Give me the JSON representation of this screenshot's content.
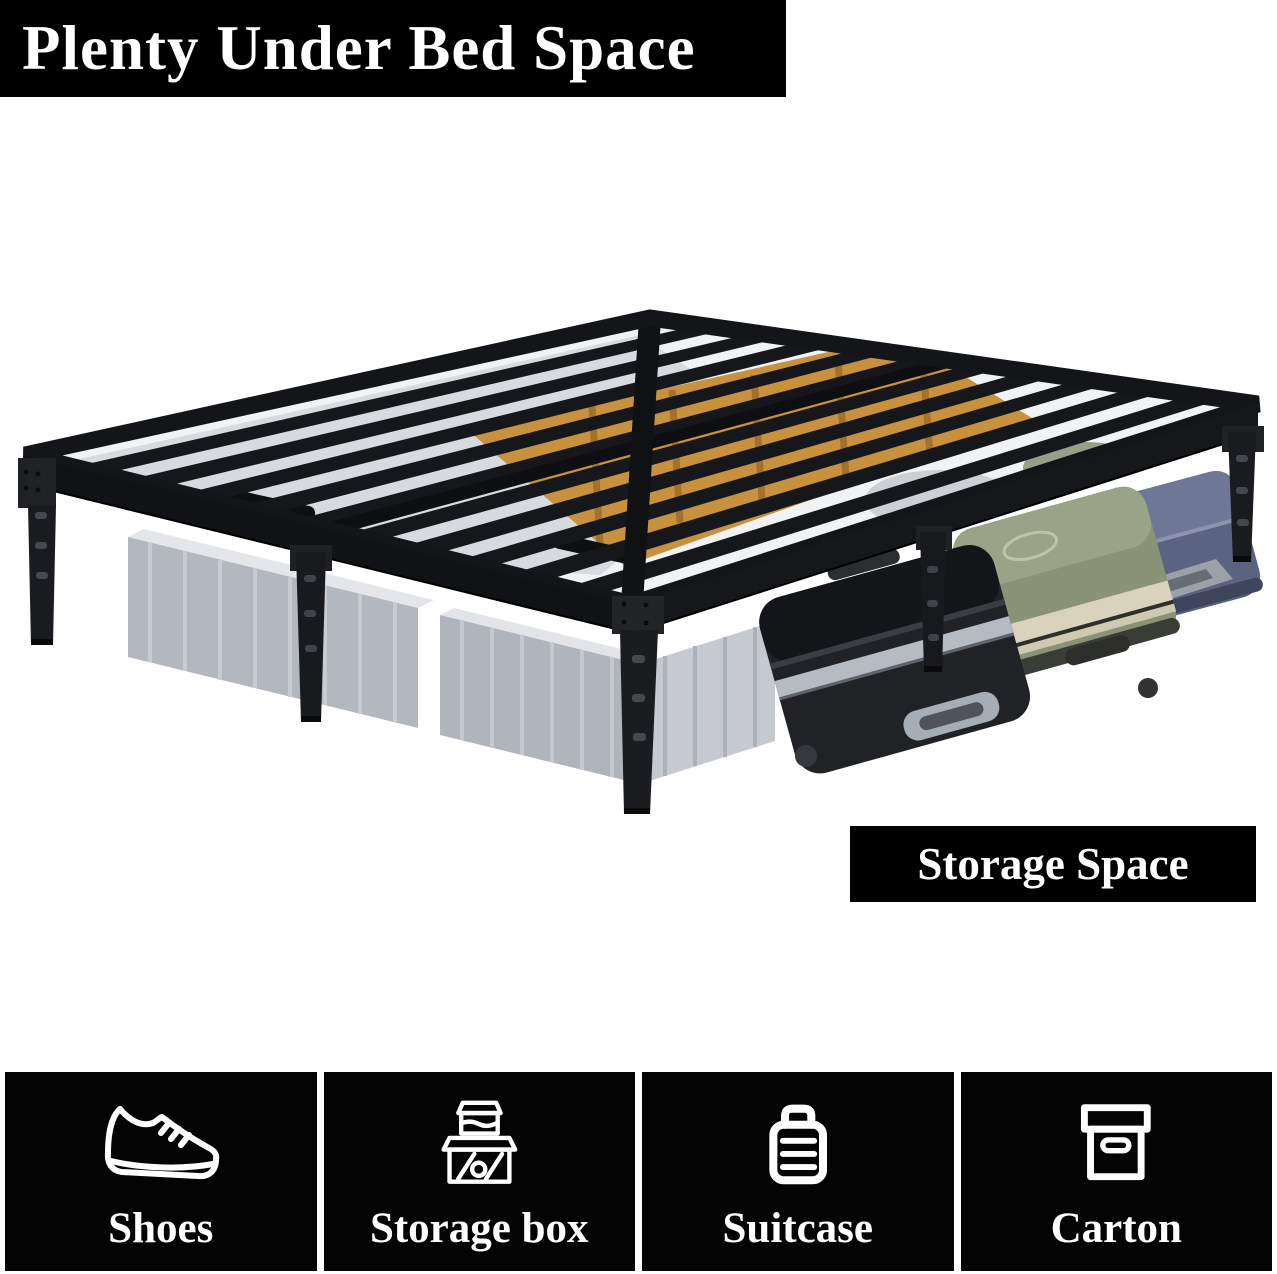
{
  "title_banner": {
    "label": "Plenty Under Bed Space",
    "bg": "#000000",
    "color": "#ffffff"
  },
  "storage_banner": {
    "label": "Storage Space",
    "bg": "#000000",
    "color": "#ffffff"
  },
  "illustration": {
    "subject": "black metal platform bed frame with under-bed storage",
    "items_shown": [
      "grey storage bins",
      "cardboard boxes",
      "black suitcase",
      "green suitcase",
      "blue suitcase"
    ],
    "colors": {
      "frame": "#16171a",
      "storage_bin": "#b3b7be",
      "cardboard": "#c8913e",
      "suitcase_black": "#202226",
      "suitcase_green": "#8a9377",
      "suitcase_blue": "#5a6380"
    }
  },
  "tiles": [
    {
      "icon": "shoe-icon",
      "label": "Shoes"
    },
    {
      "icon": "storage-box-icon",
      "label": "Storage box"
    },
    {
      "icon": "suitcase-icon",
      "label": "Suitcase"
    },
    {
      "icon": "carton-icon",
      "label": "Carton"
    }
  ]
}
